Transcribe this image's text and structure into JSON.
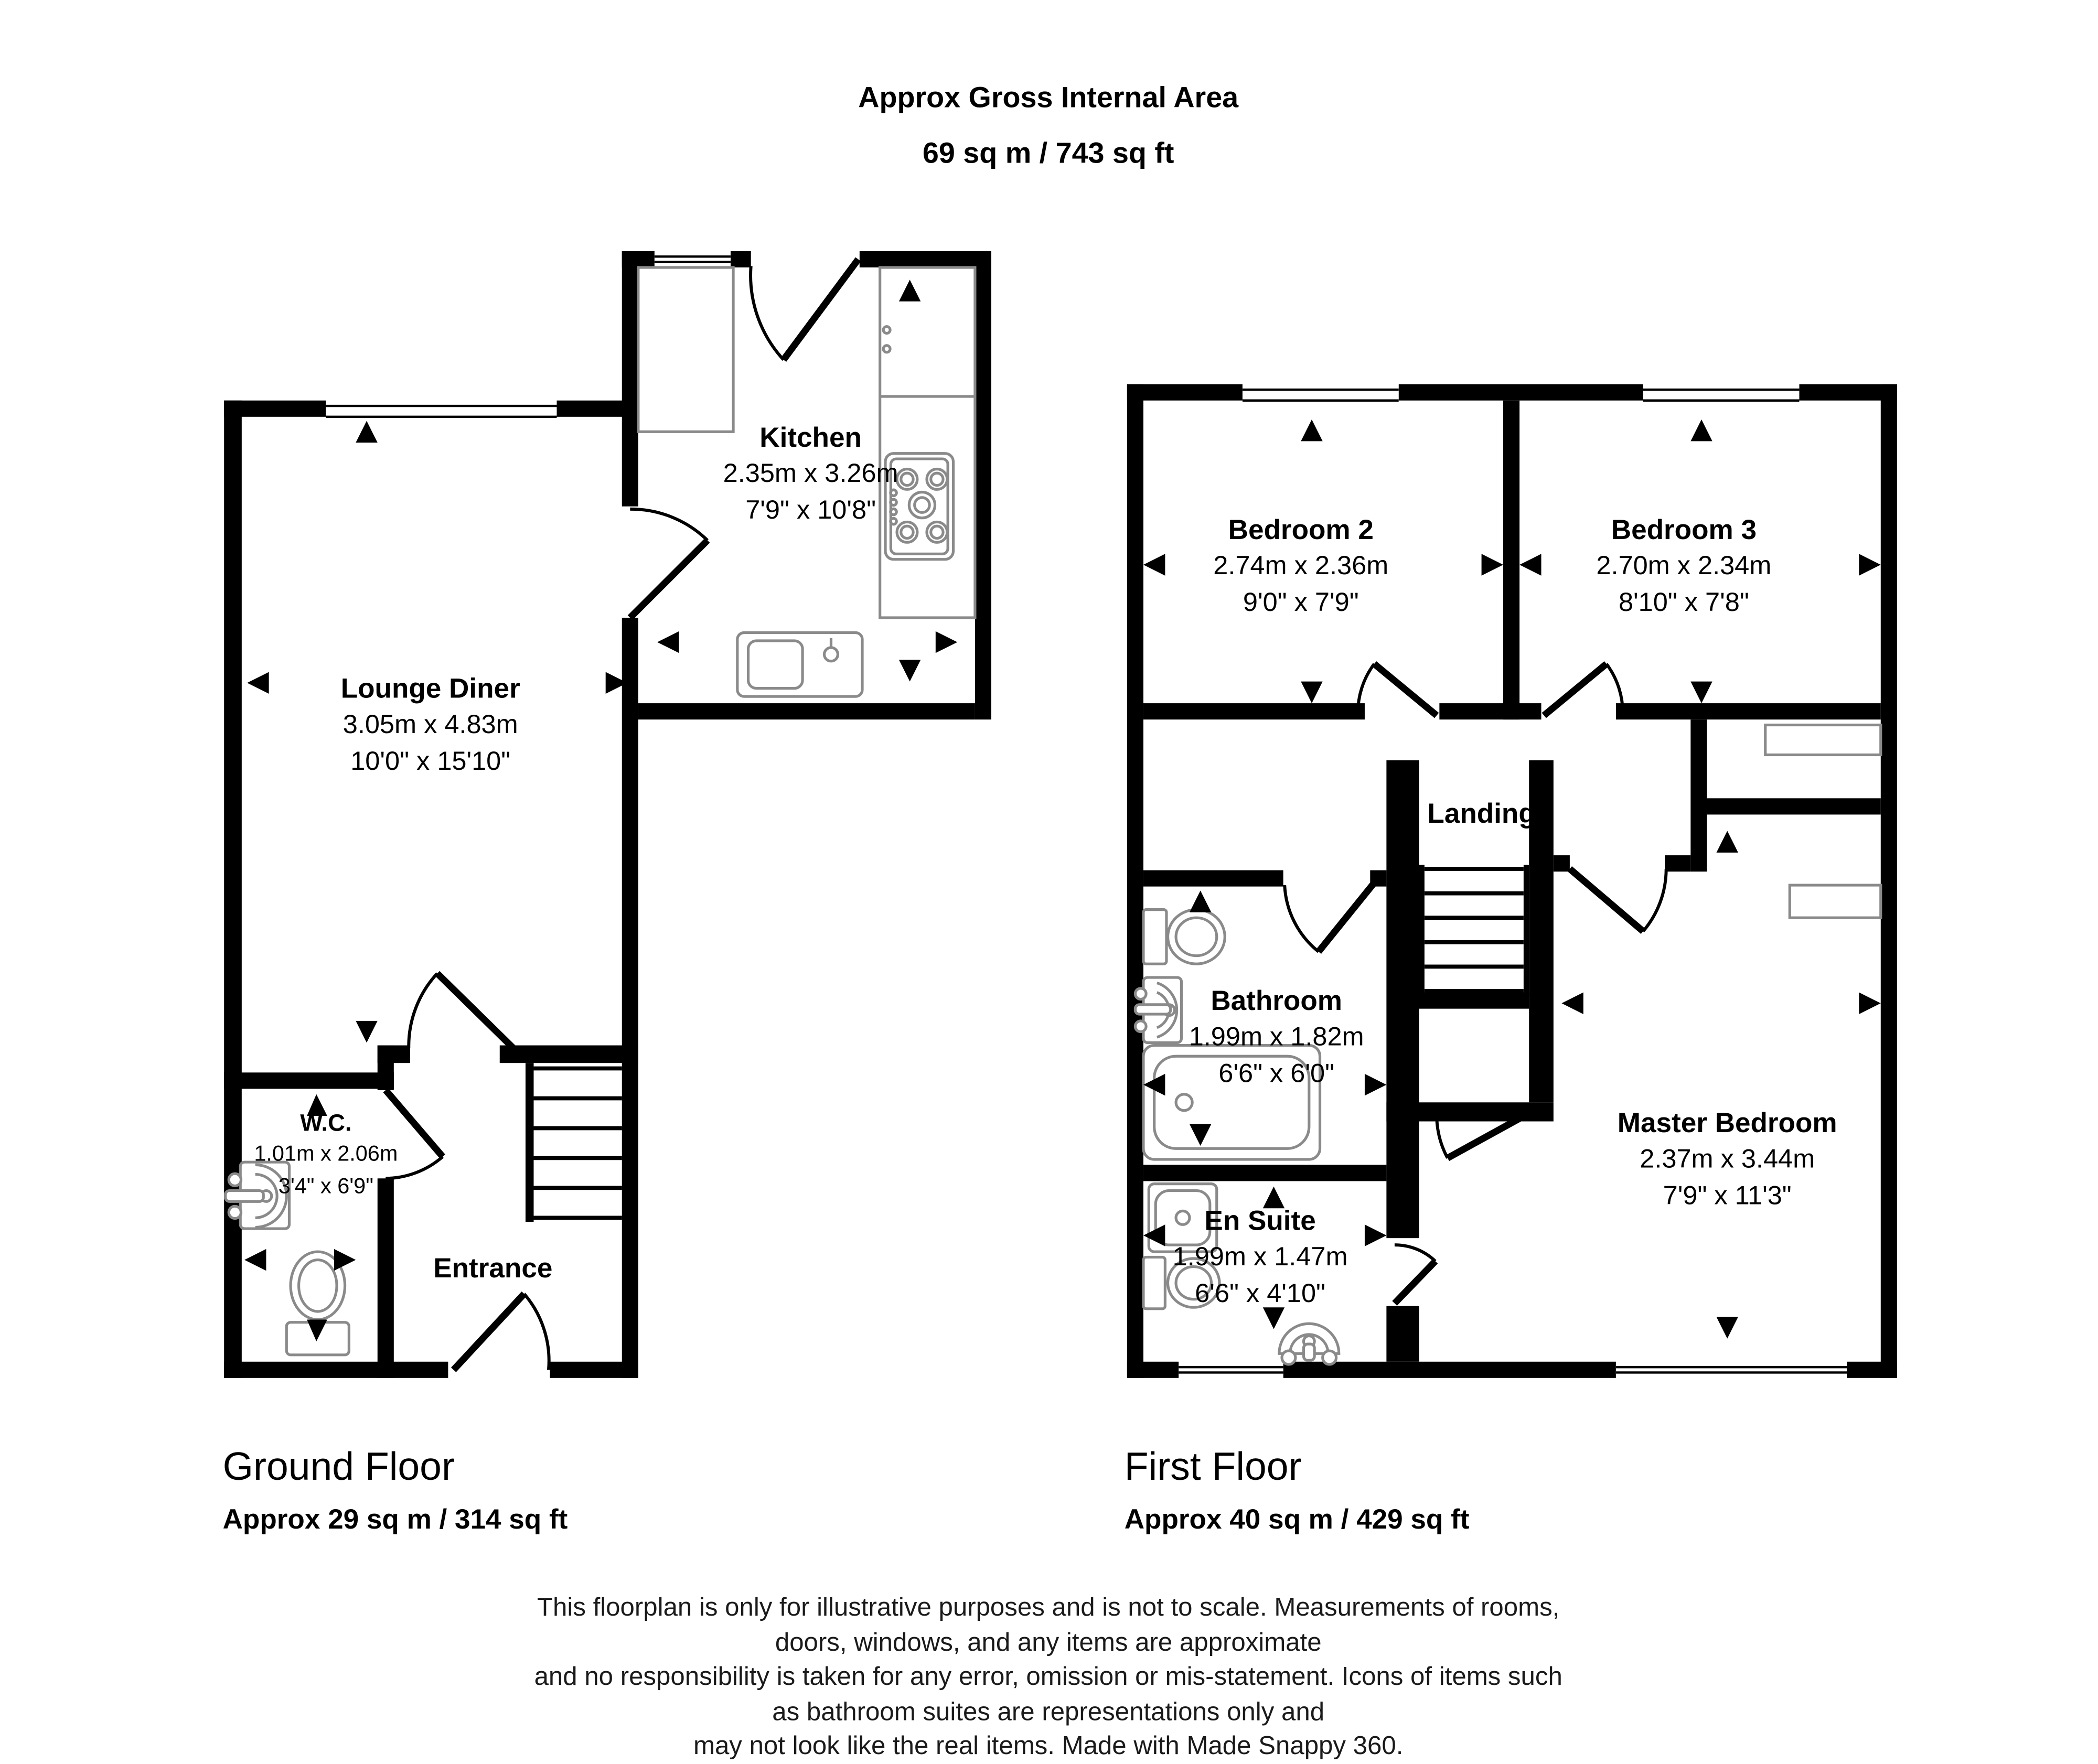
{
  "header": {
    "line1": "Approx Gross Internal Area",
    "line2": "69 sq m / 743 sq ft"
  },
  "ground_floor": {
    "title": "Ground Floor",
    "area": "Approx 29 sq m / 314 sq ft",
    "rooms": {
      "kitchen": {
        "name": "Kitchen",
        "metric": "2.35m x 3.26m",
        "imperial": "7'9\" x 10'8\""
      },
      "lounge": {
        "name": "Lounge Diner",
        "metric": "3.05m x 4.83m",
        "imperial": "10'0\" x 15'10\""
      },
      "wc": {
        "name": "W.C.",
        "metric": "1.01m x 2.06m",
        "imperial": "3'4\" x 6'9\""
      },
      "entrance": {
        "name": "Entrance"
      }
    }
  },
  "first_floor": {
    "title": "First Floor",
    "area": "Approx 40 sq m / 429 sq ft",
    "rooms": {
      "bedroom2": {
        "name": "Bedroom 2",
        "metric": "2.74m x 2.36m",
        "imperial": "9'0\" x 7'9\""
      },
      "bedroom3": {
        "name": "Bedroom 3",
        "metric": "2.70m x 2.34m",
        "imperial": "8'10\" x 7'8\""
      },
      "landing": {
        "name": "Landing"
      },
      "bathroom": {
        "name": "Bathroom",
        "metric": "1.99m x 1.82m",
        "imperial": "6'6\" x 6'0\""
      },
      "ensuite": {
        "name": "En Suite",
        "metric": "1.99m x 1.47m",
        "imperial": "6'6\" x 4'10\""
      },
      "master": {
        "name": "Master Bedroom",
        "metric": "2.37m x 3.44m",
        "imperial": "7'9\" x 11'3\""
      }
    }
  },
  "disclaimer": [
    "This floorplan is only for illustrative purposes and is not to scale. Measurements of rooms, doors, windows, and any items are approximate",
    "and no responsibility is taken for any error, omission or mis-statement. Icons of items such as bathroom suites are representations only and",
    "may not look like the real items. Made with Made Snappy 360."
  ],
  "icons": {
    "fixtures": [
      "toilet-icon",
      "basin-icon",
      "bath-icon",
      "shower-icon",
      "hob-icon",
      "sink-icon",
      "stairs-icon",
      "window-icon",
      "door-arc-icon",
      "measurement-arrow-icon"
    ]
  },
  "colors": {
    "wall": "#000000",
    "fixture": "#8a8a8a",
    "text": "#000000"
  }
}
